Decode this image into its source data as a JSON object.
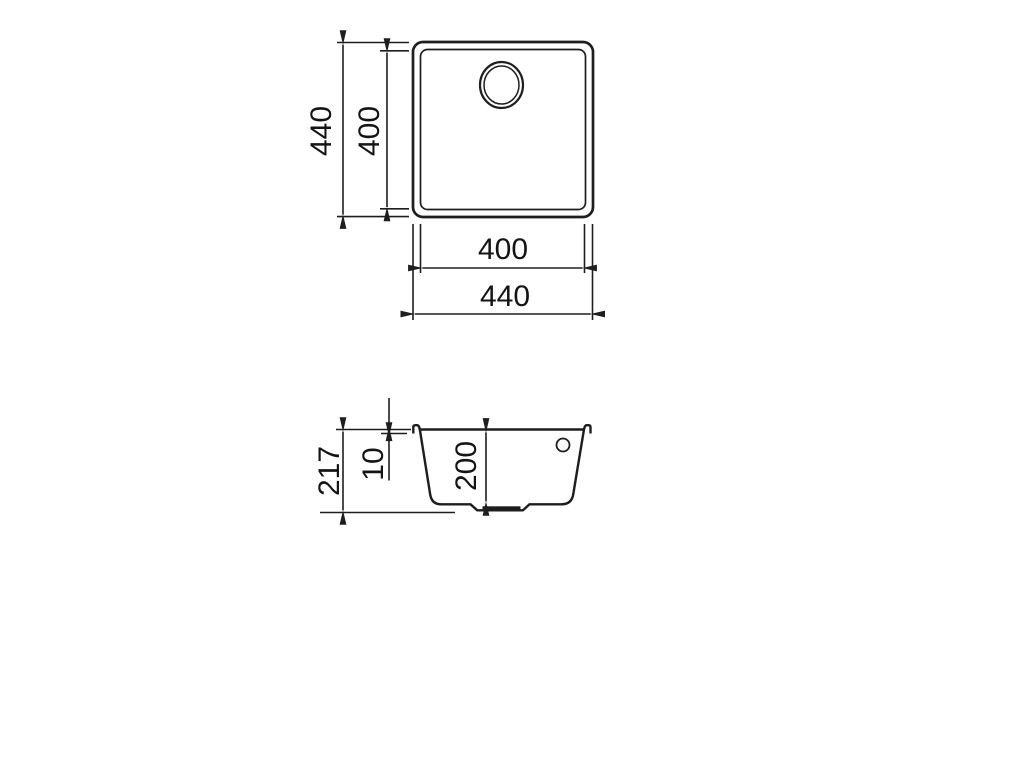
{
  "drawing": {
    "line_color": "#1e1e1e",
    "text_color": "#141414",
    "plan_view": {
      "outer_height_label": "440",
      "inner_height_label": "400",
      "inner_width_label": "400",
      "outer_width_label": "440"
    },
    "section_view": {
      "total_height_label": "217",
      "rim_thickness_label": "10",
      "bowl_depth_label": "200"
    }
  }
}
